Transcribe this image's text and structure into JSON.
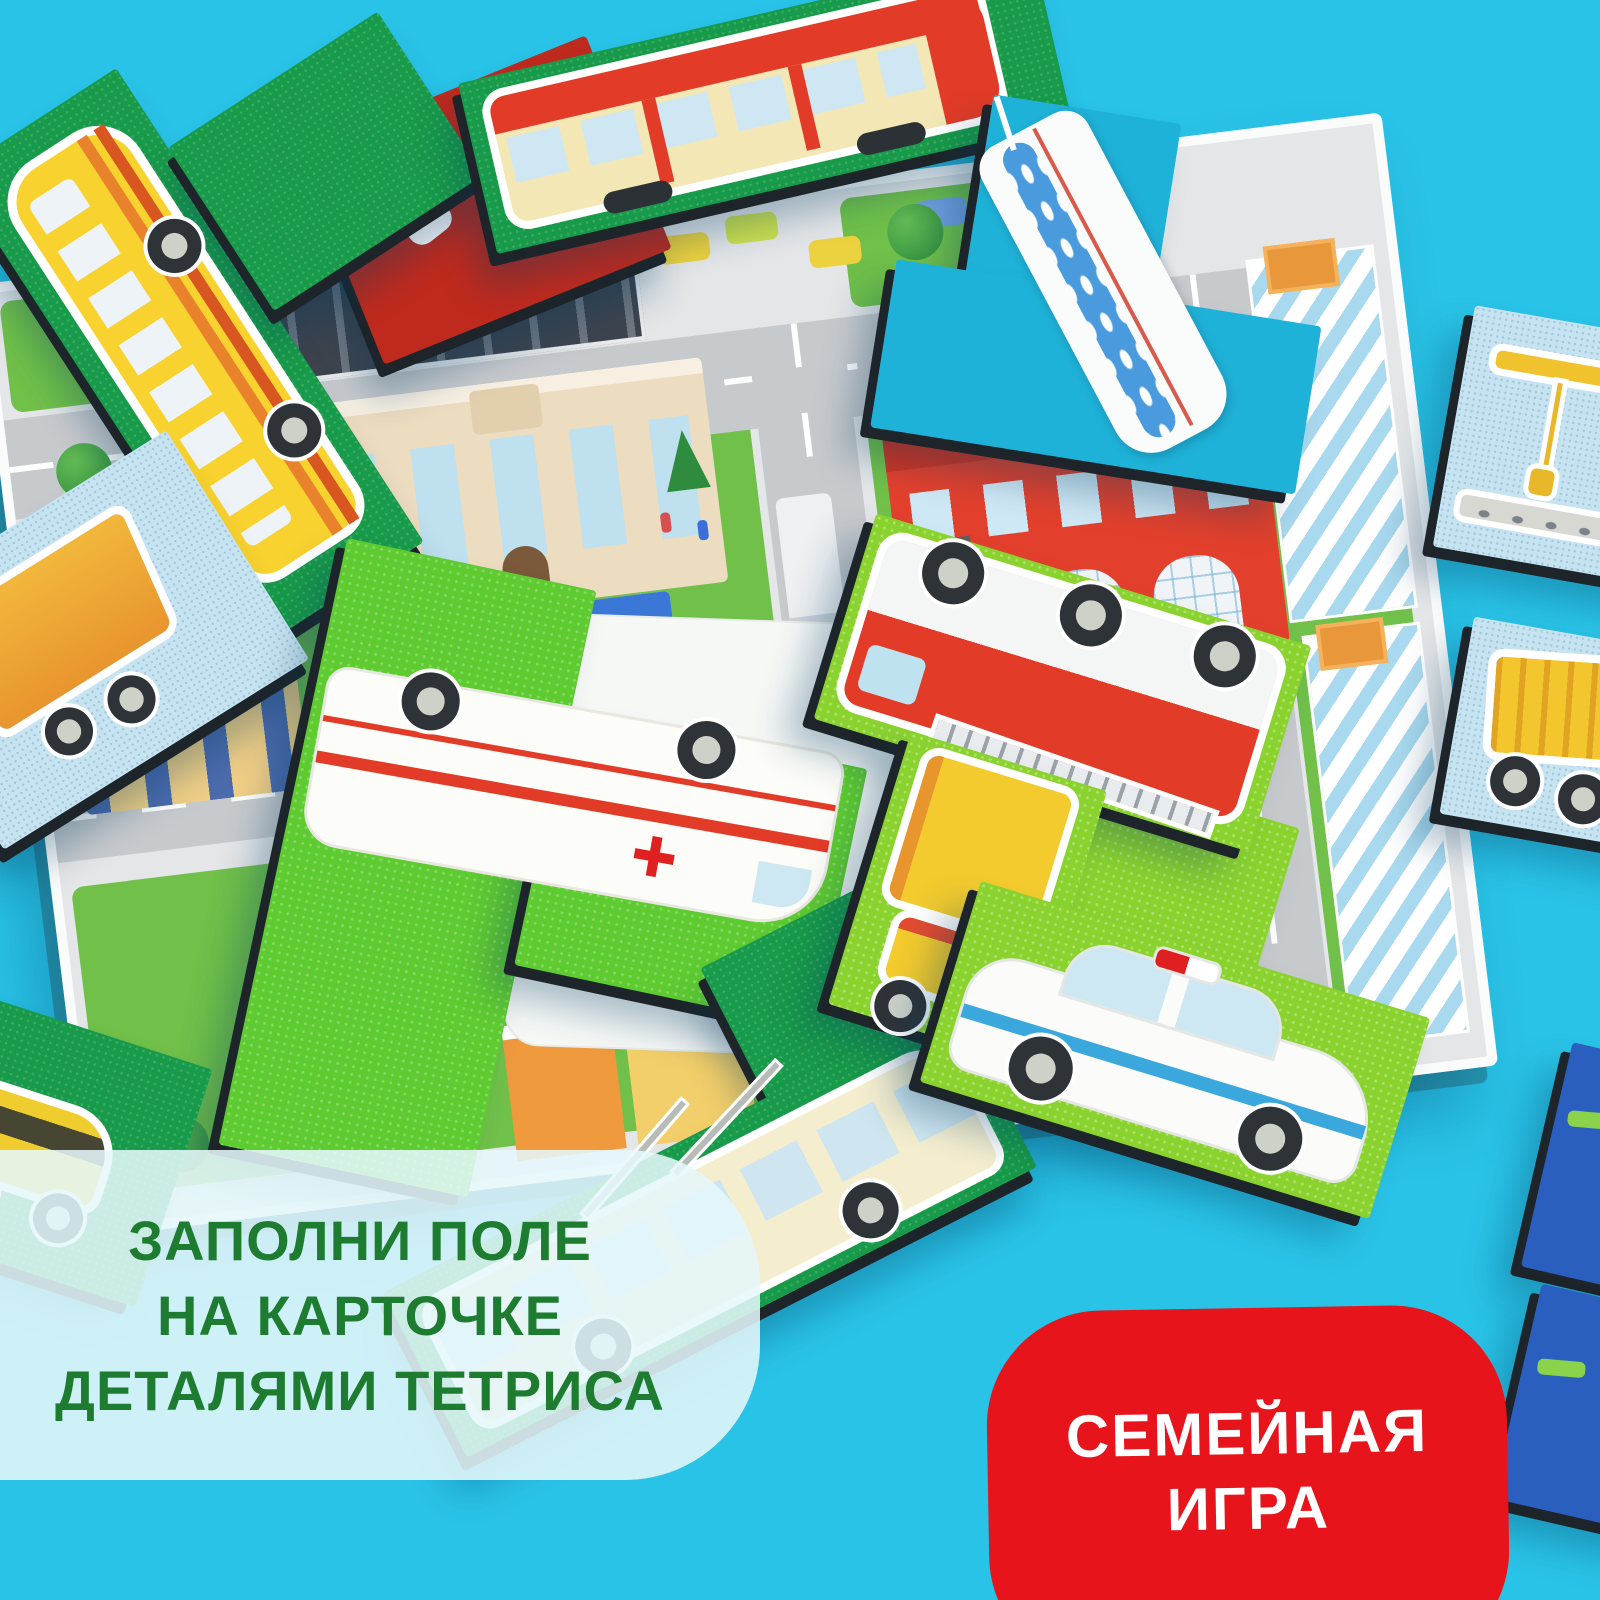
{
  "scene_type": "product-photo of a wooden tetris puzzle game on a cyan background",
  "background_color": "#29c3e7",
  "panel": {
    "lines": [
      "ЗАПОЛНИ ПОЛЕ",
      "НА КАРТОЧКЕ",
      "ДЕТАЛЯМИ ТЕТРИСА"
    ],
    "text_color": "#1e7c31",
    "bg_color": "rgba(229,247,250,0.88)"
  },
  "badge": {
    "lines": [
      "СЕМЕЙНАЯ",
      "ИГРА"
    ],
    "bg_color": "#e8141c",
    "text_color": "#ffffff"
  },
  "map": {
    "description": "isometric city play-board card",
    "buildings": [
      "shopping-mall",
      "parking-lot",
      "school",
      "hospital",
      "fire-station",
      "striped-towers",
      "apartment-block",
      "city-houses"
    ],
    "road_color": "#c7cacd",
    "lawn_color": "#70c04a",
    "white_field": "empty white card area where tetris pieces are placed"
  },
  "pieces": [
    {
      "name": "school-bus",
      "shape": "L",
      "tile_color": "#179a49",
      "vehicle_color": "#f8d22e"
    },
    {
      "name": "tram",
      "shape": "I",
      "tile_color": "#179a49",
      "vehicle_color": "#e23b27"
    },
    {
      "name": "fire-extinguisher-tile",
      "shape": "rect",
      "tile_color": "#bf2a1e"
    },
    {
      "name": "ship",
      "shape": "T",
      "tile_color": "#1fb2d8",
      "vehicle_color": "#ffffff"
    },
    {
      "name": "crane",
      "shape": "square",
      "tile_color": "#c6e3f1",
      "vehicle_color": "#f0c22e"
    },
    {
      "name": "dump-truck-orange",
      "shape": "rect",
      "tile_color": "#c6e3f1",
      "vehicle_color": "#f2a23c"
    },
    {
      "name": "dump-truck-yellow",
      "shape": "square",
      "tile_color": "#c6e3f1",
      "vehicle_color": "#f3c62e"
    },
    {
      "name": "ambulance",
      "shape": "L",
      "tile_color": "#5ecb31",
      "vehicle_color": "#fcfcf8"
    },
    {
      "name": "fire-truck",
      "shape": "I",
      "tile_color": "#8ad32e",
      "vehicle_color": "#e23b27"
    },
    {
      "name": "box-truck",
      "shape": "rect",
      "tile_color": "#8ad32e",
      "vehicle_color": "#f3cb2e"
    },
    {
      "name": "blank-tile",
      "shape": "square",
      "tile_color": "#8ad32e"
    },
    {
      "name": "police-car",
      "shape": "I",
      "tile_color": "#8ad32e",
      "vehicle_color": "#fbfcfa"
    },
    {
      "name": "trolleybus",
      "shape": "L",
      "tile_color": "#179a49",
      "vehicle_color": "#f4eecf"
    },
    {
      "name": "taxi",
      "shape": "square",
      "tile_color": "#179a49",
      "vehicle_color": "#f0cd2e"
    },
    {
      "name": "navy-tile-a",
      "shape": "rect",
      "tile_color": "#2a5fc0"
    },
    {
      "name": "navy-tile-b",
      "shape": "rect",
      "tile_color": "#2a5fc0"
    }
  ]
}
